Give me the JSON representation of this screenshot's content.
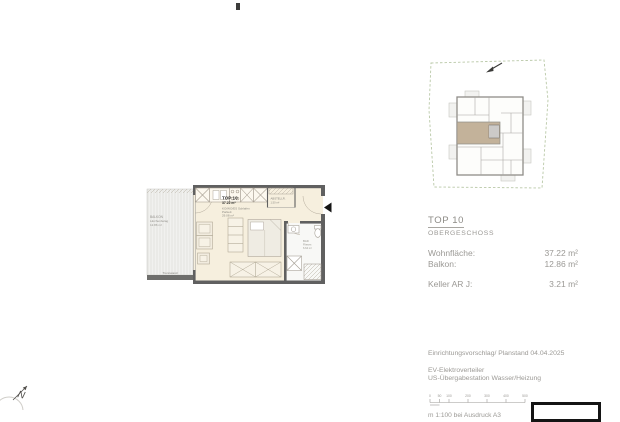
{
  "plan": {
    "unit": {
      "title": "TOP 10",
      "area": "37.22 m²"
    },
    "main_room": {
      "line1": "KO/WO/ES Schlafen",
      "line2": "Parkett",
      "line3": "29.08 m²"
    },
    "balcony": {
      "line1": "BALKON",
      "line2": "Lärchenbelag",
      "line3": "12.86 m²",
      "partition_label": "Trennwand"
    },
    "storage": {
      "line1": "ABSTELLR.",
      "line2": "1.50 m²"
    },
    "bath": {
      "line1": "BAD",
      "line2": "Fliesen",
      "line3": "6.64 m²"
    }
  },
  "overview": {
    "highlight_color": "#c3b29a",
    "boundary_color": "#b9c8a7"
  },
  "info": {
    "title": "TOP 10",
    "subtitle": "OBERGESCHOSS",
    "rows": [
      {
        "label": "Wohnfläche:",
        "value": "37.22 m²"
      },
      {
        "label": "Balkon:",
        "value": "12.86 m²"
      },
      {
        "label": "Keller AR J:",
        "value": "3.21 m²"
      }
    ]
  },
  "footer": {
    "plan_note": "Einrichtungsvorschlag/ Planstand 04.04.2025",
    "legend1": "EV-Elektroverteiler",
    "legend2": "US-Übergabestation Wasser/Heizung",
    "scale": {
      "ticks": [
        "0",
        "50",
        "100",
        "200",
        "300",
        "400",
        "500"
      ],
      "caption": "m 1:100 bei Ausdruck A3"
    }
  },
  "compass": {
    "letter": "N"
  }
}
